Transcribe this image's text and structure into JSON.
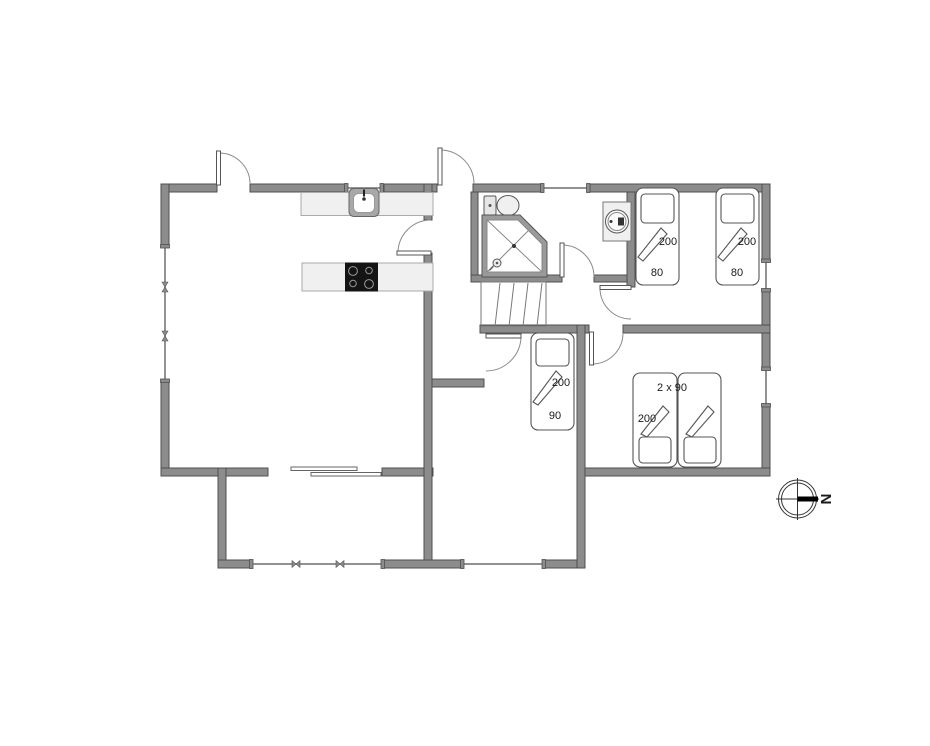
{
  "floor_plan": {
    "bedroom_top_right": {
      "bed_1": {
        "length_cm": "200",
        "width_cm": "80"
      },
      "bed_2": {
        "length_cm": "200",
        "width_cm": "80"
      }
    },
    "bedroom_middle": {
      "bed": {
        "length_cm": "200",
        "width_cm": "90"
      }
    },
    "bedroom_bottom_right": {
      "double_bed": {
        "size": "2 x 90",
        "length_cm": "200"
      }
    },
    "compass": {
      "north": "N"
    },
    "colors": {
      "wall": "#8c8c8c",
      "wall_outline": "#4f4f4f",
      "fixture_fill": "#f0f0f0",
      "stove": "#141414",
      "background": "#ffffff"
    }
  }
}
